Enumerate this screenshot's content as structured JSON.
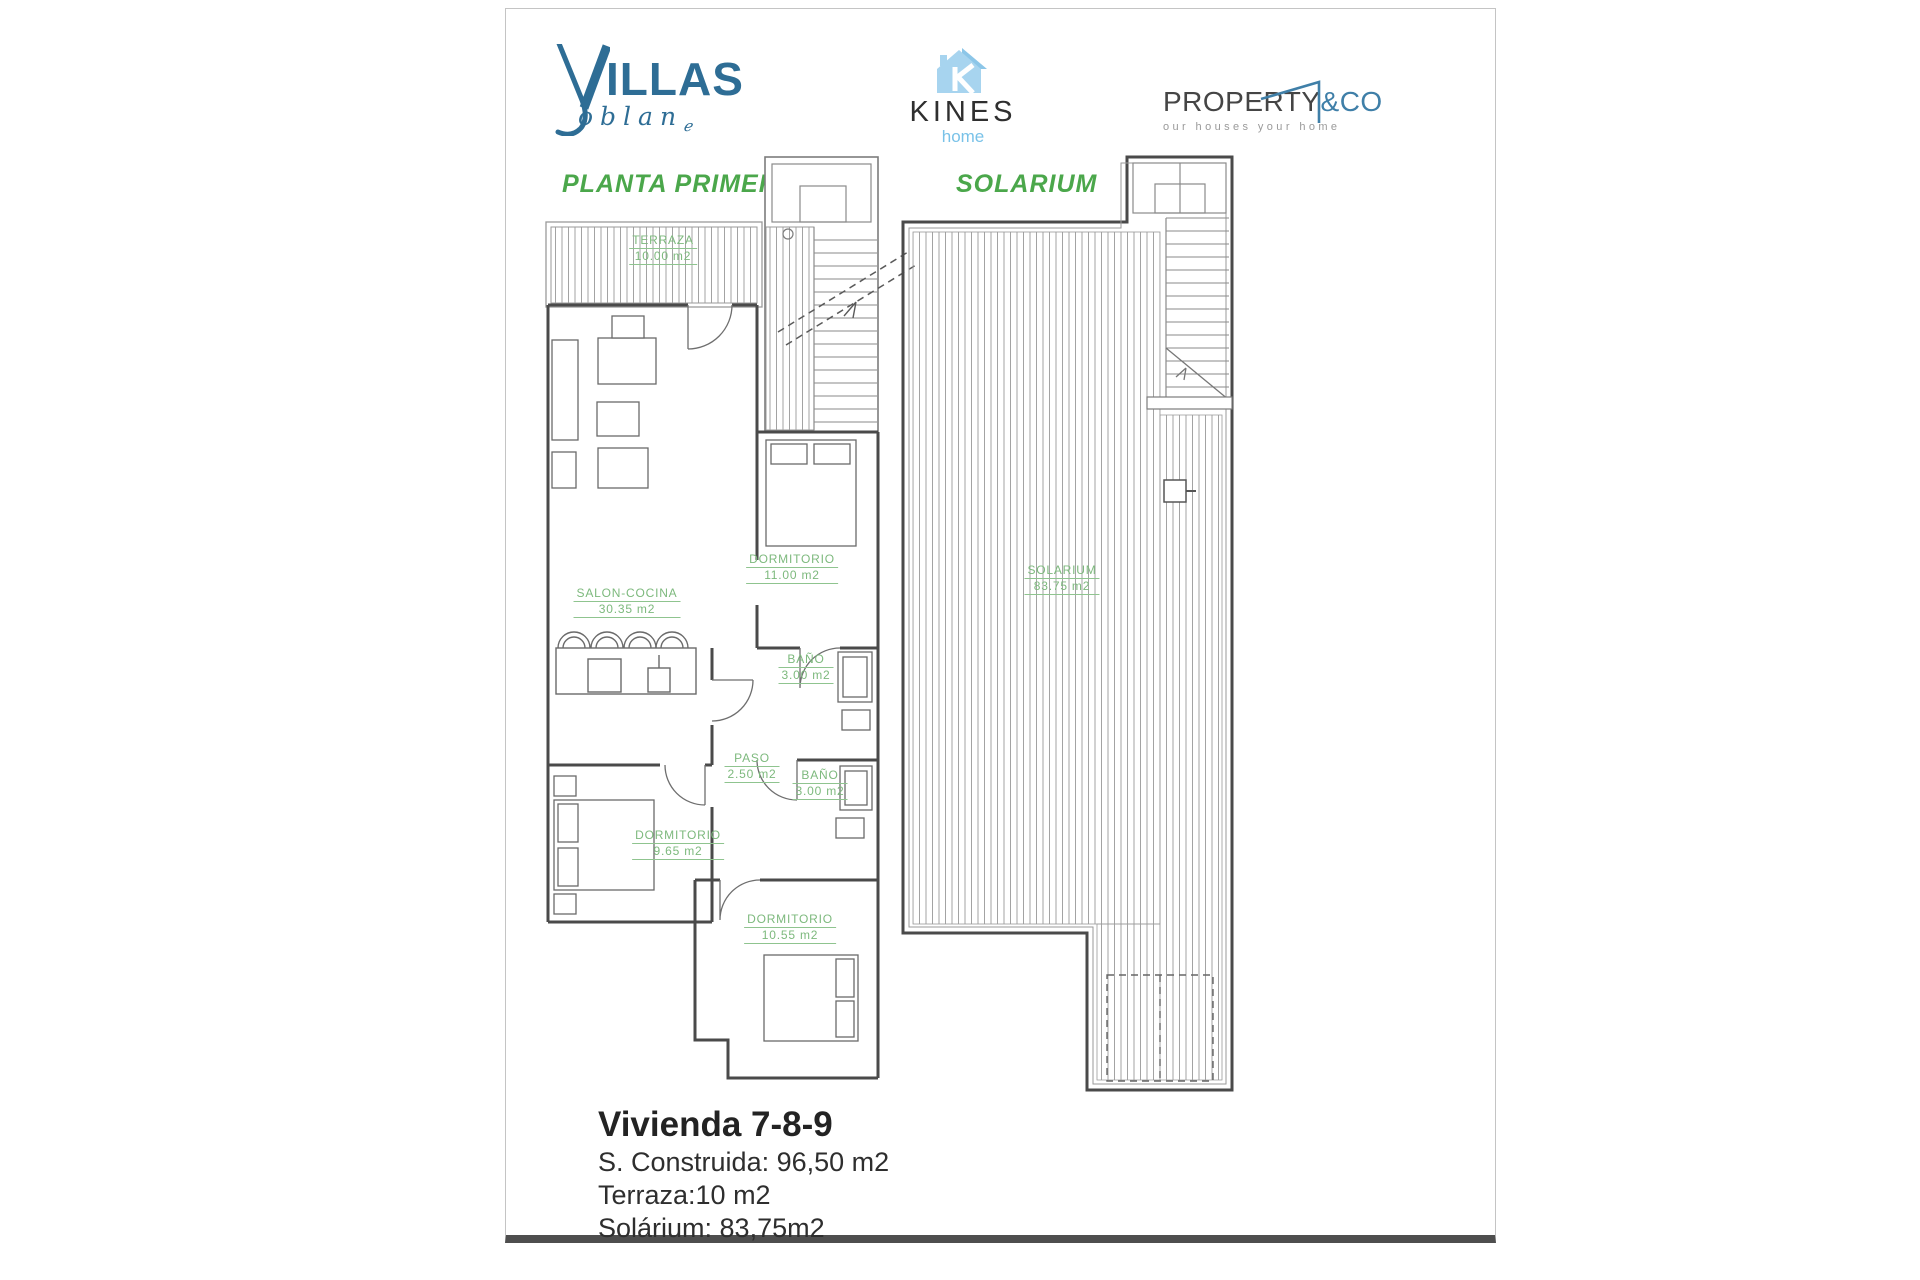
{
  "logos": {
    "villas": {
      "initial": "V",
      "rest": "ILLAS",
      "script": "oblan",
      "script_mark": "ℯ",
      "color": "#2e6d95"
    },
    "kines": {
      "name": "KINES",
      "sub": "home",
      "icon": "house-icon",
      "text_color": "#2f2f2f",
      "accent": "#a7d4ef"
    },
    "property": {
      "name": "PROPERTY",
      "amp_co": "&CO",
      "tagline": "our houses your home",
      "text_color": "#454545",
      "accent": "#3f7fa8"
    }
  },
  "plans": {
    "left_title": "PLANTA PRIMERA",
    "right_title": "SOLARIUM",
    "title_color": "#4ba74b",
    "label_color": "#7db97d",
    "wall_color": "#4a4a4a",
    "hatch_color": "#a3a3a3"
  },
  "rooms": [
    {
      "name": "TERRAZA",
      "area": "10.00 m2"
    },
    {
      "name": "SALON-COCINA",
      "area": "30.35 m2"
    },
    {
      "name": "DORMITORIO",
      "area": "11.00 m2"
    },
    {
      "name": "BAÑO",
      "area": "3.00 m2"
    },
    {
      "name": "PASO",
      "area": "2.50 m2"
    },
    {
      "name": "BAÑO",
      "area": "3.00 m2"
    },
    {
      "name": "DORMITORIO",
      "area": "9.65 m2"
    },
    {
      "name": "DORMITORIO",
      "area": "10.55 m2"
    },
    {
      "name": "SOLARIUM",
      "area": "83.75 m2"
    }
  ],
  "summary": {
    "title": "Vivienda 7-8-9",
    "line1": "S. Construida: 96,50 m2",
    "line2": "Terraza:10 m2",
    "line3": "Solárium: 83,75m2"
  }
}
